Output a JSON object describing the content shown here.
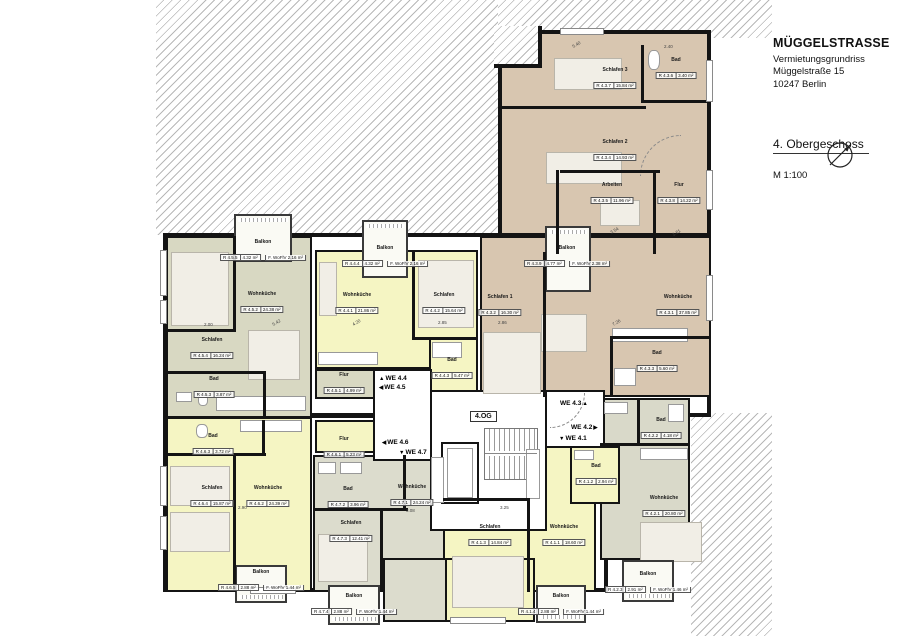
{
  "title_block": {
    "project": "MÜGGELSTRASSE",
    "subtitle": "Vermietungsgrundriss",
    "street": "Müggelstraße 15",
    "city": "10247 Berlin",
    "floor_heading": "4. Obergeschoss",
    "scale": "M 1:100"
  },
  "stairwell": {
    "floor_tag": "4.OG"
  },
  "corridor_markers": [
    {
      "label": "WE 4.4",
      "arrow": "▲"
    },
    {
      "label": "WE 4.5",
      "arrow": "◀"
    },
    {
      "label": "WE 4.6",
      "arrow": "◀"
    },
    {
      "label": "WE 4.7",
      "arrow": "▼"
    },
    {
      "label": "WE 4.3",
      "arrow": "▲"
    },
    {
      "label": "WE 4.2",
      "arrow": "▶"
    },
    {
      "label": "WE 4.1",
      "arrow": "▼"
    }
  ],
  "apartments": [
    {
      "unit": "WE 4.1",
      "rooms": [
        {
          "name": "Wohnküche",
          "ref": "R 4.1.1",
          "area": "18.60 m²"
        },
        {
          "name": "Bad",
          "ref": "R 4.1.2",
          "area": "2.94 m²"
        },
        {
          "name": "Schlafen",
          "ref": "R 4.1.3",
          "area": "14.84 m²"
        },
        {
          "name": "Balkon",
          "ref": "R 4.1.4",
          "area": "2.88 m²",
          "wofl": "F. WoFlV 1.44 m²"
        }
      ]
    },
    {
      "unit": "WE 4.2",
      "rooms": [
        {
          "name": "Wohnküche",
          "ref": "R 4.2.1",
          "area": "20.80 m²"
        },
        {
          "name": "Bad",
          "ref": "R 4.2.2",
          "area": "4.18 m²"
        },
        {
          "name": "Balkon",
          "ref": "R 4.2.3",
          "area": "2.91 m²",
          "wofl": "F. WoFlV 1.46 m²"
        }
      ]
    },
    {
      "unit": "WE 4.3",
      "rooms": [
        {
          "name": "Wohnküche",
          "ref": "R 4.3.1",
          "area": "37.85 m²"
        },
        {
          "name": "Schlafen 1",
          "ref": "R 4.3.2",
          "area": "16.30 m²"
        },
        {
          "name": "Bad",
          "ref": "R 4.3.3",
          "area": "5.60 m²"
        },
        {
          "name": "Schlafen 2",
          "ref": "R 4.3.4",
          "area": "14.93 m²"
        },
        {
          "name": "Arbeiten",
          "ref": "R 4.3.5",
          "area": "11.96 m²"
        },
        {
          "name": "Bad",
          "ref": "R 4.3.6",
          "area": "3.40 m²"
        },
        {
          "name": "Schlafen 3",
          "ref": "R 4.3.7",
          "area": "15.84 m²"
        },
        {
          "name": "Flur",
          "ref": "R 4.3.8",
          "area": "14.22 m²"
        },
        {
          "name": "Balkon",
          "ref": "R 4.3.9",
          "area": "4.77 m²",
          "wofl": "F. WoFlV 2.38 m²"
        }
      ]
    },
    {
      "unit": "WE 4.4",
      "rooms": [
        {
          "name": "Wohnküche",
          "ref": "R 4.4.1",
          "area": "21.86 m²"
        },
        {
          "name": "Schlafen",
          "ref": "R 4.4.2",
          "area": "15.64 m²"
        },
        {
          "name": "Bad",
          "ref": "R 4.4.3",
          "area": "5.47 m²"
        },
        {
          "name": "Balkon",
          "ref": "R 4.4.4",
          "area": "4.32 m²",
          "wofl": "F. WoFlV 2.16 m²"
        }
      ]
    },
    {
      "unit": "WE 4.5",
      "rooms": [
        {
          "name": "Flur",
          "ref": "R 4.5.1",
          "area": "4.99 m²"
        },
        {
          "name": "Wohnküche",
          "ref": "R 4.5.2",
          "area": "24.38 m²"
        },
        {
          "name": "Bad",
          "ref": "R 4.5.3",
          "area": "3.87 m²"
        },
        {
          "name": "Schlafen",
          "ref": "R 4.5.4",
          "area": "16.24 m²"
        },
        {
          "name": "Balkon",
          "ref": "R 4.5.5",
          "area": "4.32 m²",
          "wofl": "F. WoFlV 2.16 m²"
        }
      ]
    },
    {
      "unit": "WE 4.6",
      "rooms": [
        {
          "name": "Flur",
          "ref": "R 4.6.1",
          "area": "5.23 m²"
        },
        {
          "name": "Wohnküche",
          "ref": "R 4.6.2",
          "area": "24.39 m²"
        },
        {
          "name": "Bad",
          "ref": "R 4.6.3",
          "area": "3.72 m²"
        },
        {
          "name": "Schlafen",
          "ref": "R 4.6.4",
          "area": "15.87 m²"
        },
        {
          "name": "Balkon",
          "ref": "R 4.6.5",
          "area": "2.88 m²",
          "wofl": "F. WoFlV 1.44 m²"
        }
      ]
    },
    {
      "unit": "WE 4.7",
      "rooms": [
        {
          "name": "Wohnküche",
          "ref": "R 4.7.1",
          "area": "24.24 m²"
        },
        {
          "name": "Bad",
          "ref": "R 4.7.2",
          "area": "3.96 m²"
        },
        {
          "name": "Schlafen",
          "ref": "R 4.7.3",
          "area": "12.41 m²"
        },
        {
          "name": "Balkon",
          "ref": "R 4.7.4",
          "area": "2.88 m²",
          "wofl": "F. WoFlV 1.44 m²"
        }
      ]
    }
  ],
  "dims": [
    {
      "text": "5.40"
    },
    {
      "text": "2.40"
    },
    {
      "text": "3.54"
    },
    {
      "text": "1.61"
    },
    {
      "text": "2.86"
    },
    {
      "text": "7.26"
    },
    {
      "text": "2.00"
    },
    {
      "text": "5.42"
    },
    {
      "text": "4.20"
    },
    {
      "text": "2.85"
    },
    {
      "text": "3.08"
    },
    {
      "text": "2.90"
    },
    {
      "text": "3.25"
    }
  ],
  "colors": {
    "apartment_yellow": "#f5f5c3",
    "apartment_olive": "#d8d8c2",
    "apartment_tan": "#d8c6b0",
    "apartment_gray": "#dcdccd",
    "wall": "#141414"
  }
}
